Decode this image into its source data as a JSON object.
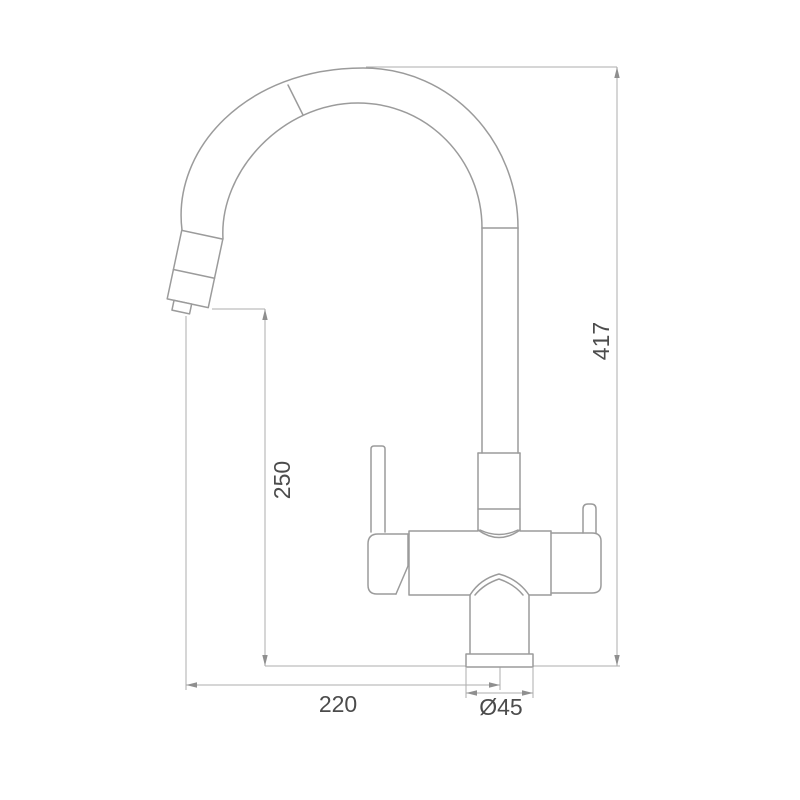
{
  "drawing": {
    "dimensions": {
      "overall_height": "417",
      "spout_outlet_height": "250",
      "spout_reach": "220",
      "base_diameter": "Ø45"
    },
    "colors": {
      "background": "#ffffff",
      "faucet_outline": "#9b9b9b",
      "dimension_lines": "#aeaeae",
      "dimension_text": "#4c4c4c"
    }
  }
}
